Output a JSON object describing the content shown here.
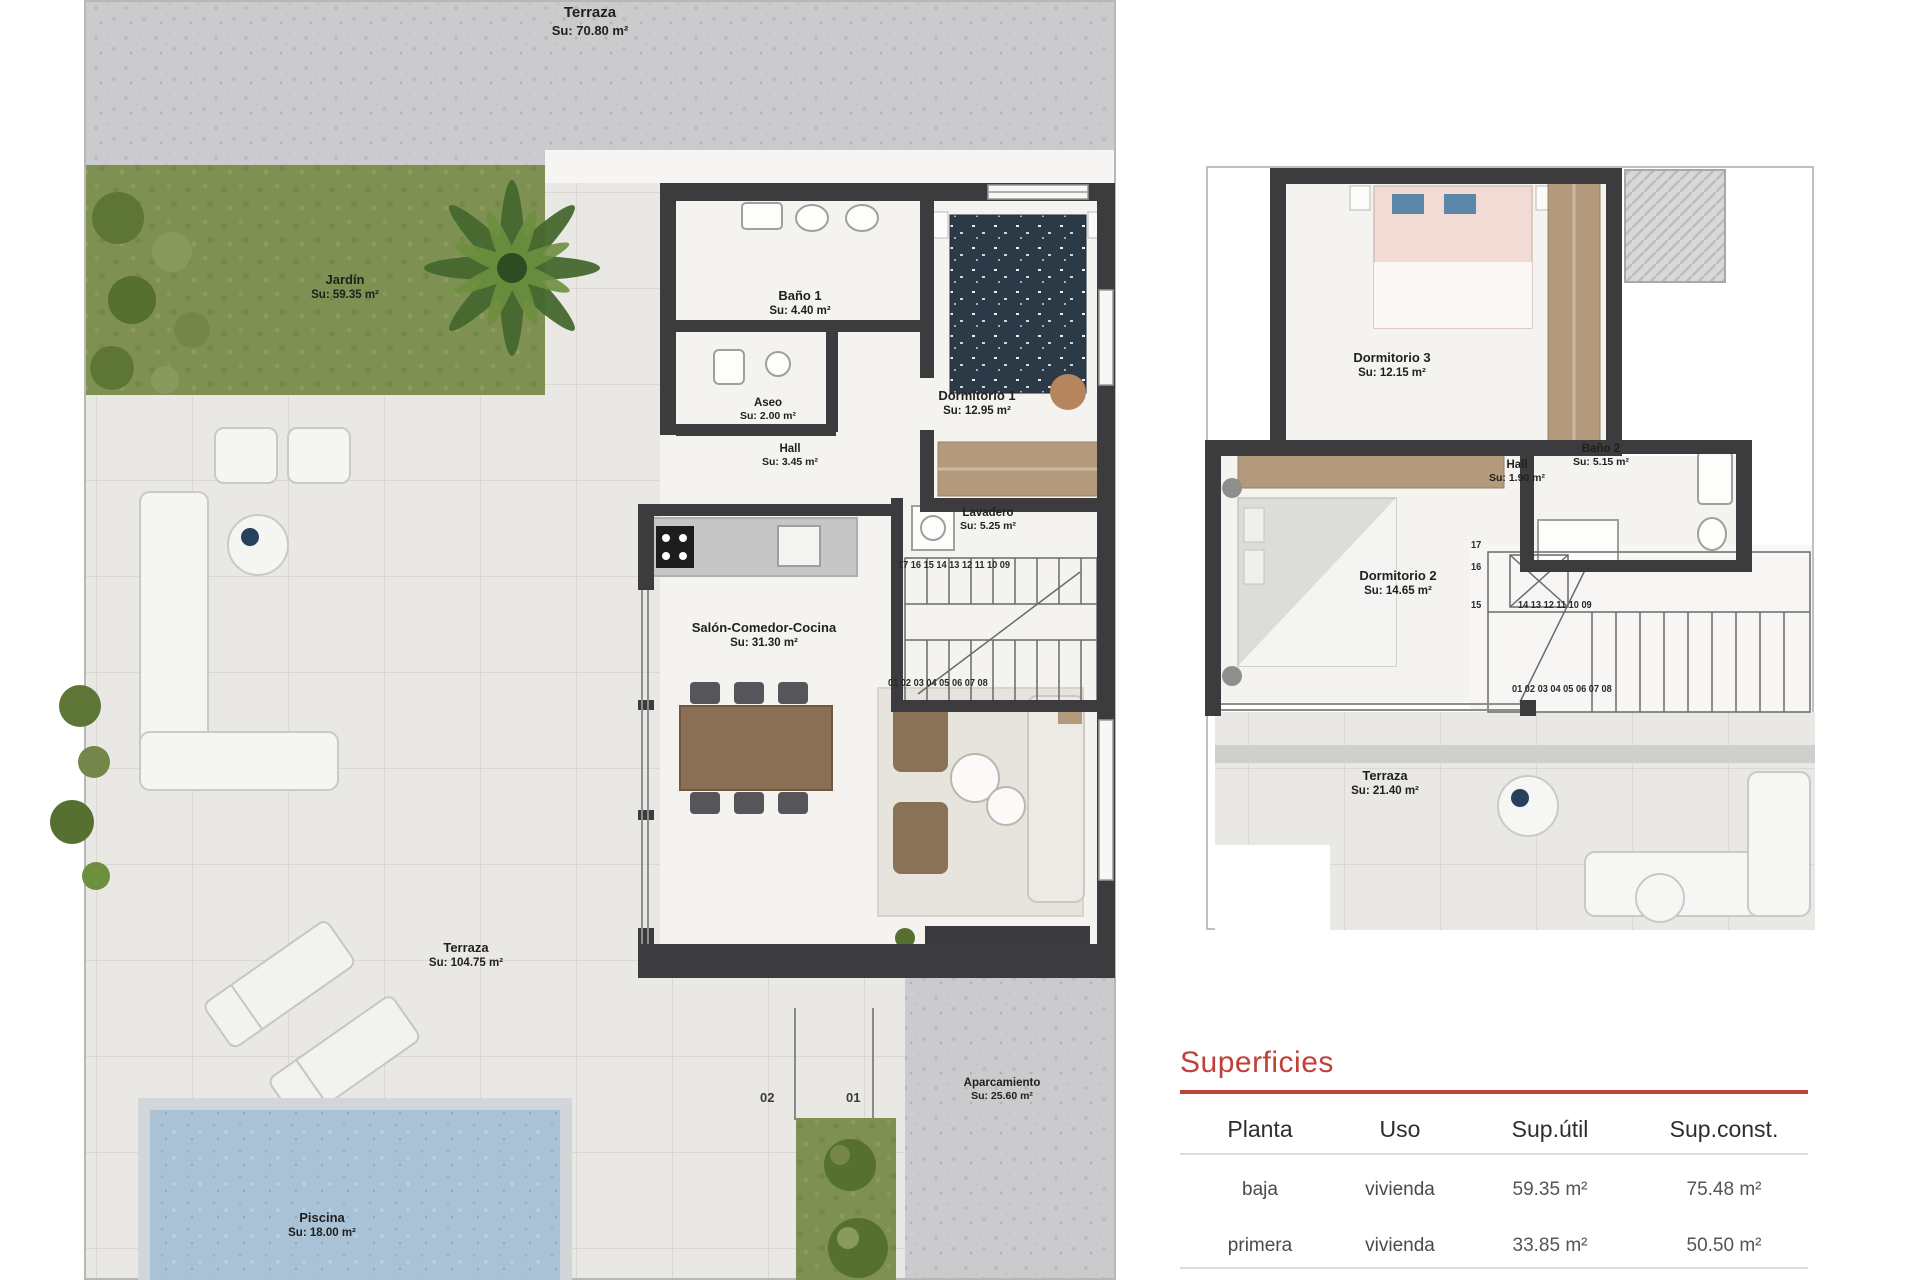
{
  "ground_floor": {
    "rooms": [
      {
        "name": "Terraza",
        "area": "Su: 70.80 m²"
      },
      {
        "name": "Jardín",
        "area": "Su: 59.35 m²"
      },
      {
        "name": "Baño 1",
        "area": "Su: 4.40 m²"
      },
      {
        "name": "Aseo",
        "area": "Su: 2.00 m²"
      },
      {
        "name": "Hall",
        "area": "Su: 3.45 m²"
      },
      {
        "name": "Dormitorio 1",
        "area": "Su: 12.95 m²"
      },
      {
        "name": "Lavadero",
        "area": "Su: 5.25 m²"
      },
      {
        "name": "Salón-Comedor-Cocina",
        "area": "Su: 31.30 m²"
      },
      {
        "name": "Terraza",
        "area": "Su: 104.75 m²"
      },
      {
        "name": "Piscina",
        "area": "Su: 18.00 m²"
      },
      {
        "name": "Aparcamiento",
        "area": "Su: 25.60 m²"
      }
    ],
    "parking": [
      "02",
      "01"
    ],
    "stairs_top": "17 16 15 14 13 12 11 10 09",
    "stairs_bottom": "01 02 03 04 05 06 07 08"
  },
  "first_floor": {
    "rooms": [
      {
        "name": "Dormitorio 3",
        "area": "Su: 12.15 m²"
      },
      {
        "name": "Hall",
        "area": "Su: 1.90 m²"
      },
      {
        "name": "Baño 2",
        "area": "Su: 5.15 m²"
      },
      {
        "name": "Dormitorio 2",
        "area": "Su: 14.65 m²"
      },
      {
        "name": "Terraza",
        "area": "Su: 21.40 m²"
      }
    ],
    "stairs_col": [
      "17",
      "16",
      "15"
    ],
    "stairs_top": "14 13 12 11 10 09",
    "stairs_bottom": "01 02 03 04 05 06 07 08"
  },
  "superficies": {
    "title": "Superficies",
    "columns": [
      "Planta",
      "Uso",
      "Sup.útil",
      "Sup.const."
    ],
    "rows": [
      {
        "planta": "baja",
        "uso": "vivienda",
        "sup_util": "59.35 m²",
        "sup_const": "75.48 m²"
      },
      {
        "planta": "primera",
        "uso": "vivienda",
        "sup_util": "33.85 m²",
        "sup_const": "50.50 m²"
      },
      {
        "planta": "Total",
        "uso": "",
        "sup_util": "93.20 m²",
        "sup_const": "125.98 m²"
      }
    ]
  },
  "colors": {
    "wall": "#3c3c3e",
    "accent_red": "#c0403a",
    "pool": "#a9c2d5",
    "grass": "#7e9052",
    "wood": "#b49a7d",
    "navy_bed": "#2c3946",
    "pink_bed": "#f2dbd5",
    "concrete": "#cbcbcd",
    "tile": "#eae8e4"
  }
}
